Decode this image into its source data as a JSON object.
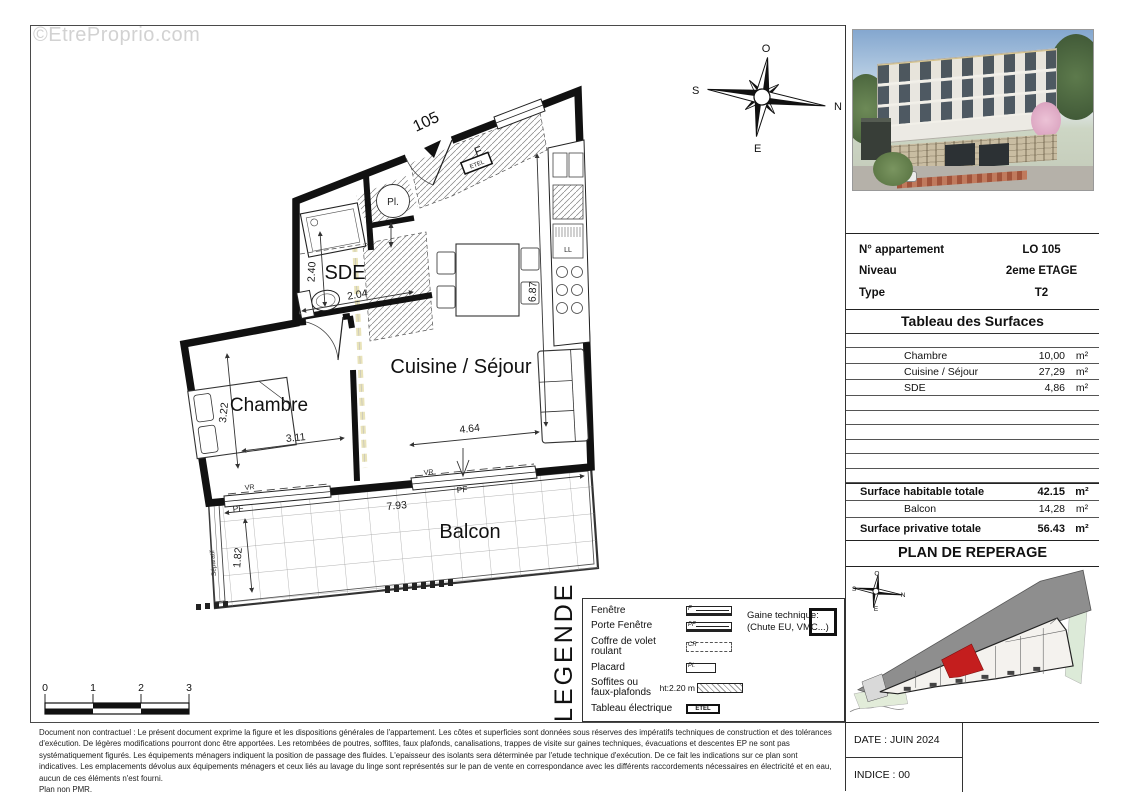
{
  "watermark": "©EtreProprio.com",
  "colors": {
    "wall": "#111111",
    "highlight_unit": "#c41e1e",
    "road_gray": "#8e8e8e",
    "soffit_dash": "#e9e3b9"
  },
  "floor_plan": {
    "unit_marker": "105",
    "room_labels": {
      "sde": "SDE",
      "cuisine_sejour": "Cuisine / Séjour",
      "chambre": "Chambre",
      "balcon": "Balcon"
    },
    "dims": {
      "sde_h": "2.40",
      "sde_w": "2.04",
      "sejour_h": "6.87",
      "sejour_w": "4.64",
      "chambre_h": "3.22",
      "chambre_w": "3.11",
      "balcon_w": "7.93",
      "balcon_h": "1.82"
    },
    "fixtures": {
      "placard": "Pl.",
      "etel": "ETEL",
      "fenetre": "F",
      "volet": "VR",
      "porte_fenetre": "PF",
      "separatif": "Séparatif"
    },
    "compass": {
      "top": "O",
      "right": "N",
      "bottom": "E",
      "left": "S"
    },
    "scale": [
      "0",
      "1",
      "2",
      "3"
    ]
  },
  "legend": {
    "title": "LEGENDE",
    "items": [
      {
        "label": "Fenêtre",
        "symbol": "F"
      },
      {
        "label": "Porte Fenêtre",
        "symbol": "PF"
      },
      {
        "label": "Coffre de volet roulant",
        "symbol": "CR"
      },
      {
        "label": "Placard",
        "symbol": "Pl."
      },
      {
        "label": "Soffites ou faux-plafonds",
        "note": "ht:2.20 m",
        "symbol": ""
      },
      {
        "label": "Tableau électrique",
        "symbol": "ETEL"
      }
    ],
    "gaine_label": "Gaine technique:",
    "gaine_note": "(Chute EU, VMC...)"
  },
  "panel": {
    "info": {
      "rows": [
        {
          "label": "N° appartement",
          "value": "LO 105"
        },
        {
          "label": "Niveau",
          "value": "2eme ETAGE"
        },
        {
          "label": "Type",
          "value": "T2"
        }
      ]
    },
    "surfaces": {
      "title": "Tableau des Surfaces",
      "rows": [
        {
          "label": "Chambre",
          "value": "10,00",
          "unit": "m²"
        },
        {
          "label": "Cuisine / Séjour",
          "value": "27,29",
          "unit": "m²"
        },
        {
          "label": "SDE",
          "value": "4,86",
          "unit": "m²"
        }
      ],
      "totals": [
        {
          "label": "Surface habitable totale",
          "value": "42.15",
          "unit": "m²"
        },
        {
          "label": "Balcon",
          "value": "14,28",
          "unit": "m²"
        },
        {
          "label": "Surface privative totale",
          "value": "56.43",
          "unit": "m²"
        }
      ]
    },
    "reperage": {
      "title": "PLAN DE REPERAGE",
      "compass": {
        "top": "O",
        "right": "N",
        "bottom": "E",
        "left": "S"
      }
    },
    "footer": {
      "date": "DATE : JUIN 2024",
      "indice": "INDICE : 00"
    }
  },
  "disclaimer": {
    "text": "Document non contractuel : Le présent document exprime la figure et les dispositions générales de l'appartement. Les côtes et superficies sont données sous réserves des impératifs techniques de construction et des tolérances d'exécution. De légères modifications pourront donc être apportées. Les retombées de poutres, soffites, faux plafonds, canalisations, trappes de visite sur gaines techniques, évacuations et descentes EP ne sont pas systématiquement figurés. Les équipements ménagers indiquent la position de passage des fluides. L'epaisseur des isolants sera déterminée par l'etude technique d'exécution. De ce fait les indications sur ce plan sont indicatives. Les emplacements dévolus aux équipements ménagers et ceux liés au lavage du linge sont représentés sur le pan de vente en correspondance avec les différents raccordements nécessaires en électricité et en eau, aucun de ces éléments n'est fourni.",
    "last_line": "Plan non PMR."
  }
}
